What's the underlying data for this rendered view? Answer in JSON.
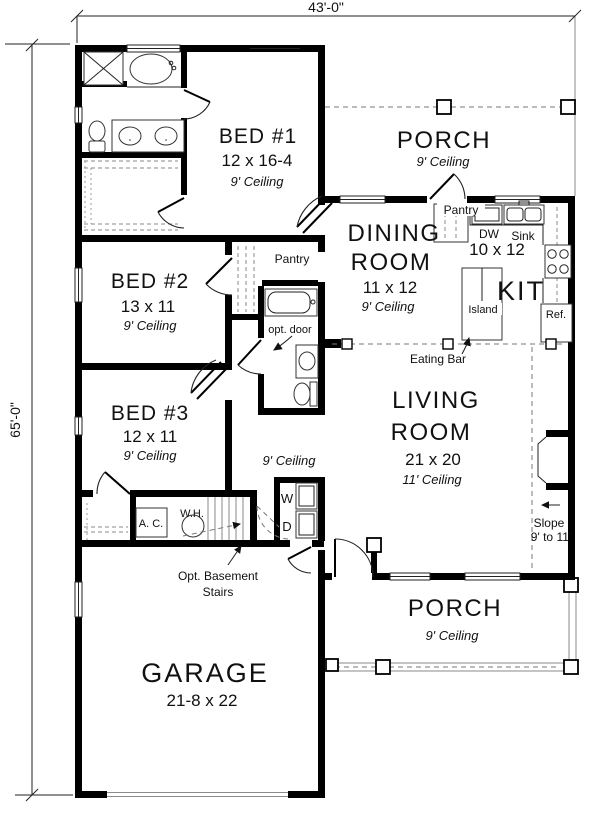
{
  "title": "House floor plan",
  "dimensions": {
    "width_label": "43'-0\"",
    "height_label": "65'-0\""
  },
  "rooms": {
    "porch_top": {
      "name": "PORCH",
      "ceiling": "9' Ceiling"
    },
    "porch_bottom": {
      "name": "PORCH",
      "ceiling": "9' Ceiling"
    },
    "bed1": {
      "name": "BED #1",
      "size": "12 x 16-4",
      "ceiling": "9' Ceiling"
    },
    "bed2": {
      "name": "BED #2",
      "size": "13 x 11",
      "ceiling": "9' Ceiling"
    },
    "bed3": {
      "name": "BED #3",
      "size": "12 x 11",
      "ceiling": "9' Ceiling"
    },
    "dining": {
      "line1": "DINING",
      "line2": "ROOM",
      "size": "11 x 12",
      "ceiling": "9' Ceiling"
    },
    "kitchen": {
      "name": "KIT",
      "size": "10 x 12"
    },
    "living": {
      "line1": "LIVING",
      "line2": "ROOM",
      "size": "21 x 20",
      "ceiling": "11' Ceiling"
    },
    "garage": {
      "name": "GARAGE",
      "size": "21-8 x 22"
    },
    "hall": {
      "ceiling": "9' Ceiling"
    }
  },
  "labels": {
    "pantry_kitchen": "Pantry",
    "pantry_walkin": "Pantry",
    "dw": "DW",
    "sink": "Sink",
    "island": "Island",
    "ref": "Ref.",
    "eating_bar": "Eating Bar",
    "opt_door": "opt. door",
    "washer": "W",
    "dryer": "D",
    "ac": "A. C.",
    "wh": "W.H.",
    "opt_basement_line1": "Opt. Basement",
    "opt_basement_line2": "Stairs",
    "slope_line1": "Slope",
    "slope_line2": "9' to 11'"
  },
  "colors": {
    "wall": "#000000",
    "background": "#ffffff",
    "thin_line": "#222222",
    "light_line": "#8a8a8a",
    "dashed_line": "#777777"
  }
}
